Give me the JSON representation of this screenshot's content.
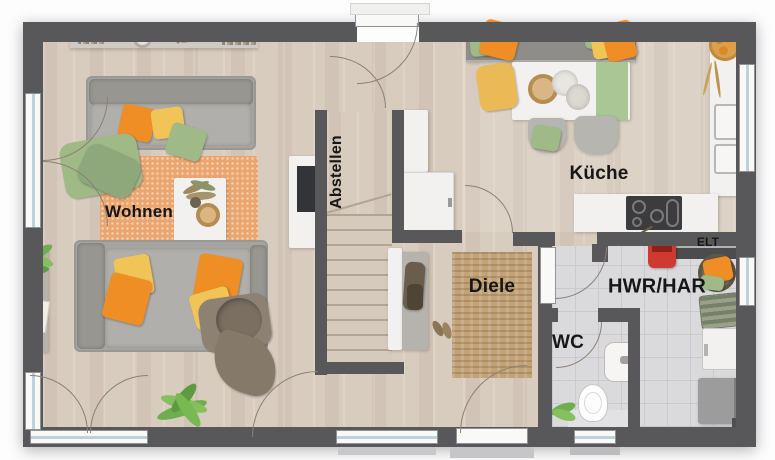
{
  "rooms": {
    "living": {
      "label": "Wohnen"
    },
    "storage": {
      "label": "Abstellen"
    },
    "kitchen": {
      "label": "Küche"
    },
    "hall": {
      "label": "Diele"
    },
    "wc": {
      "label": "WC"
    },
    "utility": {
      "label": "HWR/HAR"
    },
    "electrical": {
      "label": "ELT"
    }
  },
  "colors": {
    "wall": "#58585a",
    "wood_floor": "#d8ccbe",
    "tile_floor": "#dadadc",
    "stair_wood": "#d6cabc",
    "living_rug": "#eba670",
    "hall_rug": "#c2a277",
    "sofa_gray": "#a6a4a0",
    "furniture_white": "#f2f1ef",
    "pillow_orange": "#ef8e25",
    "pillow_yellow": "#f0c457",
    "pillow_green": "#9fb987",
    "red_appliance": "#cf3a30"
  }
}
